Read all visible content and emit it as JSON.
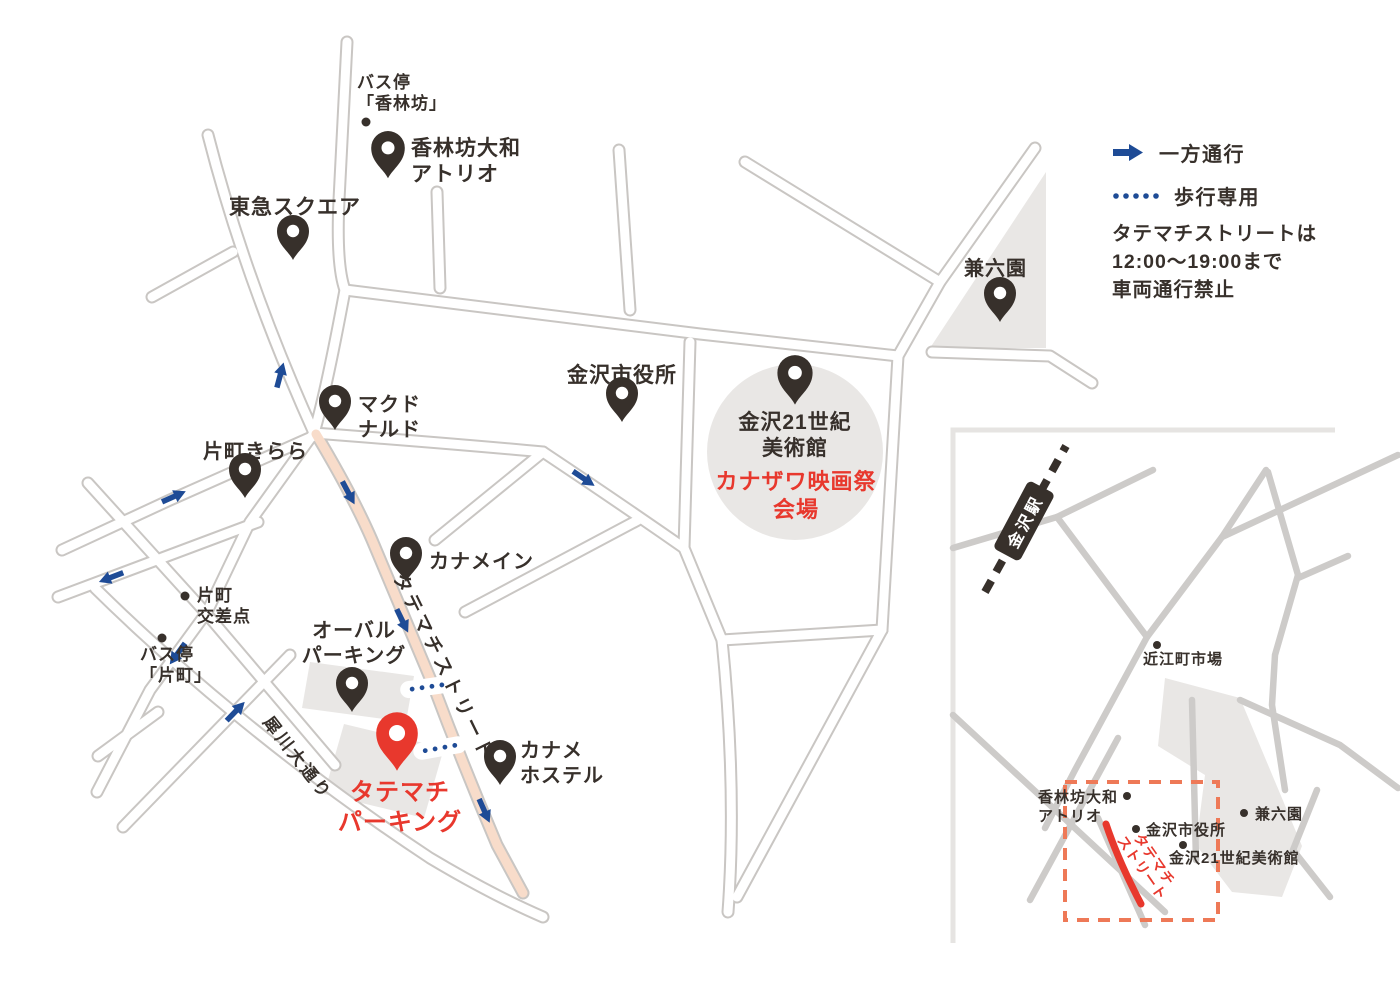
{
  "title": "カナザワ映画祭 会場アクセスマップ",
  "colors": {
    "ink": "#37302b",
    "blue": "#1e4b96",
    "red": "#e8382d",
    "street_peach": "#f8dcca",
    "area_gray": "#e9e7e5",
    "dashed_box": "#ee7957"
  },
  "legend": {
    "one_way": "一方通行",
    "pedestrian_only": "歩行専用"
  },
  "note": {
    "lines": [
      "タテマチストリートは",
      "12:00〜19:00まで",
      "車両通行禁止"
    ]
  },
  "map": {
    "places": [
      {
        "id": "bus-stop-korinbo",
        "lines": [
          "バス停",
          "「香林坊」"
        ],
        "x": 357,
        "y": 72,
        "size": 17,
        "dot": {
          "x": 366,
          "y": 122
        }
      },
      {
        "id": "korinbo-daiwa-atrio",
        "lines": [
          "香林坊大和",
          "アトリオ"
        ],
        "x": 411,
        "y": 136,
        "size": 21,
        "pin": {
          "x": 388,
          "y": 151,
          "s": 1.05,
          "c": "ink"
        }
      },
      {
        "id": "tokyu-square",
        "lines": [
          "東急スクエア"
        ],
        "x": 229,
        "y": 195,
        "size": 21,
        "pin": {
          "x": 293,
          "y": 234,
          "s": 1,
          "c": "ink"
        }
      },
      {
        "id": "mcdonalds",
        "lines": [
          "マクド",
          "ナルド"
        ],
        "x": 358,
        "y": 393,
        "size": 20,
        "pin": {
          "x": 335,
          "y": 404,
          "s": 1,
          "c": "ink"
        }
      },
      {
        "id": "katamachi-kirara",
        "lines": [
          "片町きらら"
        ],
        "x": 203,
        "y": 440,
        "size": 20,
        "pin": {
          "x": 245,
          "y": 472,
          "s": 1,
          "c": "ink"
        }
      },
      {
        "id": "city-hall",
        "lines": [
          "金沢市役所"
        ],
        "x": 567,
        "y": 363,
        "size": 21,
        "pin": {
          "x": 622,
          "y": 396,
          "s": 1,
          "c": "ink"
        }
      },
      {
        "id": "museum-21c",
        "lines": [
          "金沢21世紀",
          "美術館"
        ],
        "x": 795,
        "y": 410,
        "size": 21,
        "align": "center",
        "pin": {
          "x": 795,
          "y": 376,
          "s": 1.1,
          "c": "ink"
        }
      },
      {
        "id": "film-festival-venue",
        "lines": [
          "カナザワ映画祭",
          "会場"
        ],
        "x": 796,
        "y": 468,
        "size": 22,
        "align": "center",
        "color": "red"
      },
      {
        "id": "kenrokuen",
        "lines": [
          "兼六園"
        ],
        "x": 964,
        "y": 257,
        "size": 20,
        "pin": {
          "x": 1000,
          "y": 296,
          "s": 1,
          "c": "ink"
        }
      },
      {
        "id": "kaname-inn",
        "lines": [
          "カナメイン"
        ],
        "x": 429,
        "y": 550,
        "size": 20,
        "pin": {
          "x": 406,
          "y": 556,
          "s": 1,
          "c": "ink"
        }
      },
      {
        "id": "oval-parking",
        "lines": [
          "オーバル",
          "パーキング"
        ],
        "x": 354,
        "y": 619,
        "size": 20,
        "align": "center",
        "pin": {
          "x": 352,
          "y": 686,
          "s": 1,
          "c": "ink"
        }
      },
      {
        "id": "tatemachi-parking",
        "lines": [
          "タテマチ",
          "パーキング"
        ],
        "x": 400,
        "y": 778,
        "size": 24,
        "align": "center",
        "color": "red",
        "pin": {
          "x": 397,
          "y": 737,
          "s": 1.3,
          "c": "red"
        }
      },
      {
        "id": "kaname-hostel",
        "lines": [
          "カナメ",
          "ホステル"
        ],
        "x": 520,
        "y": 739,
        "size": 20,
        "pin": {
          "x": 500,
          "y": 759,
          "s": 1,
          "c": "ink"
        }
      },
      {
        "id": "katamachi-crossing",
        "lines": [
          "片町",
          "交差点"
        ],
        "x": 197,
        "y": 585,
        "size": 17,
        "dot": {
          "x": 185,
          "y": 596
        }
      },
      {
        "id": "bus-stop-katamachi",
        "lines": [
          "バス停",
          "「片町」"
        ],
        "x": 140,
        "y": 644,
        "size": 17,
        "dot": {
          "x": 162,
          "y": 638
        }
      }
    ],
    "road_labels": [
      {
        "id": "saigawa-odori",
        "text": "犀川大通り",
        "x": 299,
        "y": 757,
        "rotate": 52,
        "size": 17,
        "spacing": 3
      },
      {
        "id": "tatemachi-street",
        "text": "タテマチストリート",
        "x": 445,
        "y": 667,
        "rotate": 64,
        "size": 19,
        "spacing": 4
      }
    ],
    "arrows": [
      {
        "x": 280,
        "y": 376,
        "a": -75
      },
      {
        "x": 348,
        "y": 492,
        "a": 62
      },
      {
        "x": 402,
        "y": 620,
        "a": 64
      },
      {
        "x": 484,
        "y": 810,
        "a": 66
      },
      {
        "x": 173,
        "y": 497,
        "a": -24
      },
      {
        "x": 112,
        "y": 577,
        "a": 159
      },
      {
        "x": 235,
        "y": 712,
        "a": -46
      },
      {
        "x": 178,
        "y": 653,
        "a": 126
      },
      {
        "x": 583,
        "y": 478,
        "a": 34
      }
    ],
    "ped_paths": [
      {
        "x": 427,
        "y": 687,
        "a": -8
      },
      {
        "x": 440,
        "y": 748,
        "a": -10
      }
    ]
  },
  "inset": {
    "station": {
      "label": "金沢駅",
      "x": 1024,
      "y": 521,
      "rotate": -62
    },
    "street_label": {
      "lines": [
        "タテマチ",
        "ストリート"
      ],
      "x": 1148,
      "y": 864,
      "rotate": 55
    },
    "places": [
      {
        "id": "omicho-market",
        "lines": [
          "近江町市場"
        ],
        "x": 1143,
        "y": 651,
        "size": 15,
        "dot": {
          "x": 1157,
          "y": 645
        }
      },
      {
        "id": "korinbo-daiwa-atrio-inset",
        "lines": [
          "香林坊大和",
          "アトリオ"
        ],
        "x": 1038,
        "y": 789,
        "size": 15,
        "dot": {
          "x": 1127,
          "y": 796
        }
      },
      {
        "id": "kenrokuen-inset",
        "lines": [
          "兼六園"
        ],
        "x": 1255,
        "y": 806,
        "size": 15,
        "dot": {
          "x": 1244,
          "y": 813
        }
      },
      {
        "id": "city-hall-inset",
        "lines": [
          "金沢市役所"
        ],
        "x": 1146,
        "y": 822,
        "size": 15,
        "dot": {
          "x": 1136,
          "y": 829
        }
      },
      {
        "id": "museum-21c-inset",
        "lines": [
          "金沢21世紀美術館"
        ],
        "x": 1169,
        "y": 850,
        "size": 15,
        "dot": {
          "x": 1183,
          "y": 845
        }
      }
    ]
  }
}
